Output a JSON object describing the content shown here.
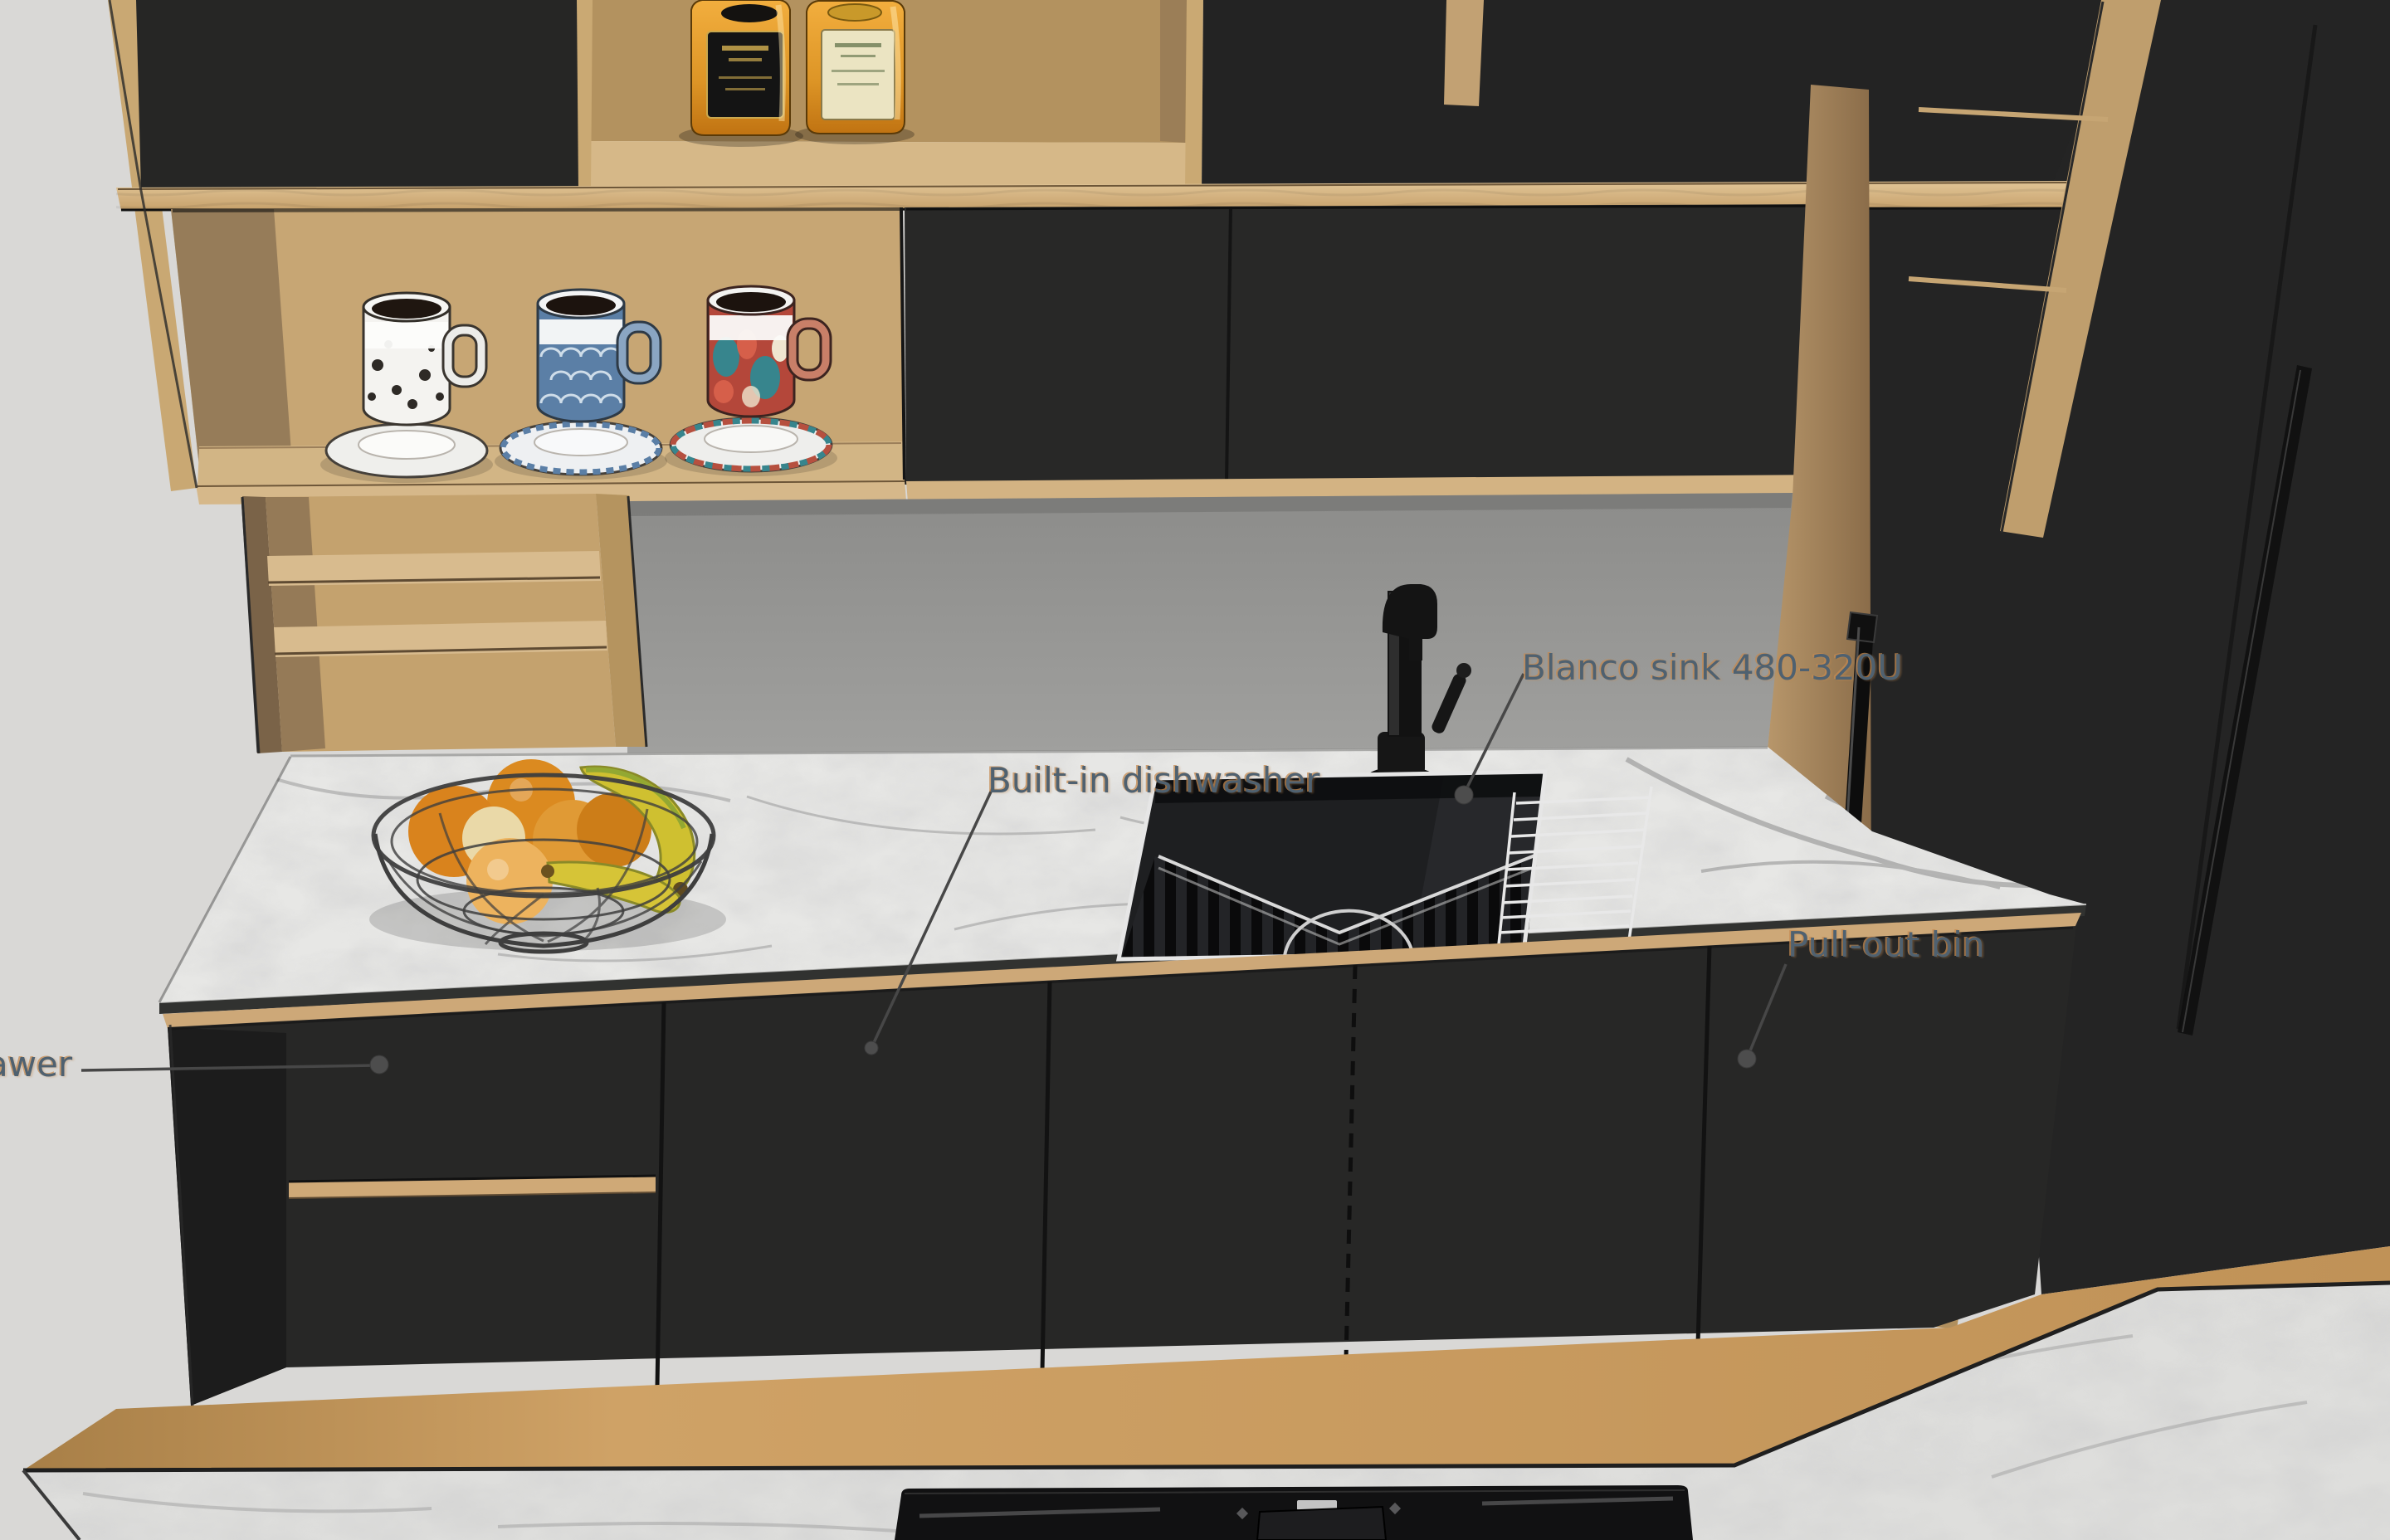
{
  "annotations": [
    {
      "id": "drawer",
      "label": "awer",
      "clipped_at_left_edge": true
    },
    {
      "id": "dishwasher",
      "label": "Built-in dishwasher"
    },
    {
      "id": "sink",
      "label": "Blanco sink 480-320U"
    },
    {
      "id": "bin",
      "label": "Pull-out bin"
    }
  ],
  "colors": {
    "annotation_text": "#4f6170",
    "annotation_halo": "#c48a50",
    "leader_line": "#474747",
    "wall": "#d9d8d6",
    "backsplash": "#919190",
    "cabinet_black": "#262626",
    "wood_light": "#d7b98c",
    "wood_mid": "#c7a674",
    "wood_dark": "#8a7051",
    "wood_floor": "#c79a5e",
    "marble": "#e7e7e5",
    "bottle_amber": "#dd9526",
    "orange_fruit": "#df8f24",
    "banana": "#cfc12e",
    "mug_blue": "#5b7fa6",
    "mug_red": "#c0483a",
    "mug_teal": "#37858d"
  }
}
